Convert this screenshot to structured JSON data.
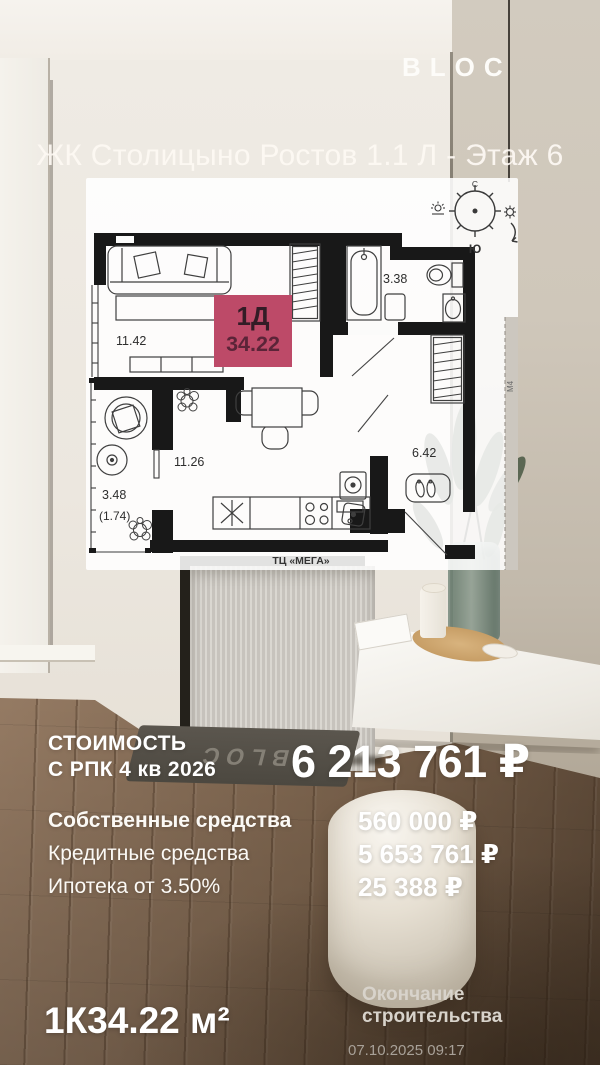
{
  "brand": {
    "logo_text": "BLOC",
    "doormat_text": "BLOC"
  },
  "header": {
    "title": "ЖК Столицыно Ростов 1.1 Л - Этаж 6"
  },
  "floor_plan": {
    "unit_badge": {
      "unit_type": "1Д",
      "area": "34.22",
      "bg_color": "#bd4a68"
    },
    "rooms": {
      "living": "11.42",
      "bathroom": "3.38",
      "kitchen": "11.26",
      "hallway": "6.42",
      "balcony": "3.48",
      "balcony_reduced": "(1.74)"
    },
    "compass": {
      "north": "С",
      "south": "Ю"
    },
    "mall_label": "ТЦ «МЕГА»",
    "section_label": "М4"
  },
  "pricing": {
    "heading_line1": "СТОИМОСТЬ",
    "heading_line2": "С РПК 4 кв 2026",
    "total": "6 213 761 ₽",
    "rows": [
      {
        "label": "Собственные средства",
        "value": "560 000 ₽"
      },
      {
        "label": "Кредитные средства",
        "value": "5 653 761 ₽"
      },
      {
        "label": "Ипотека от 3.50%",
        "value": "25 388 ₽"
      }
    ]
  },
  "footer": {
    "unit_type": "1К",
    "unit_area": "34.22 м²",
    "completion_label": "Окончание строительства",
    "timestamp": "07.10.2025 09:17"
  }
}
